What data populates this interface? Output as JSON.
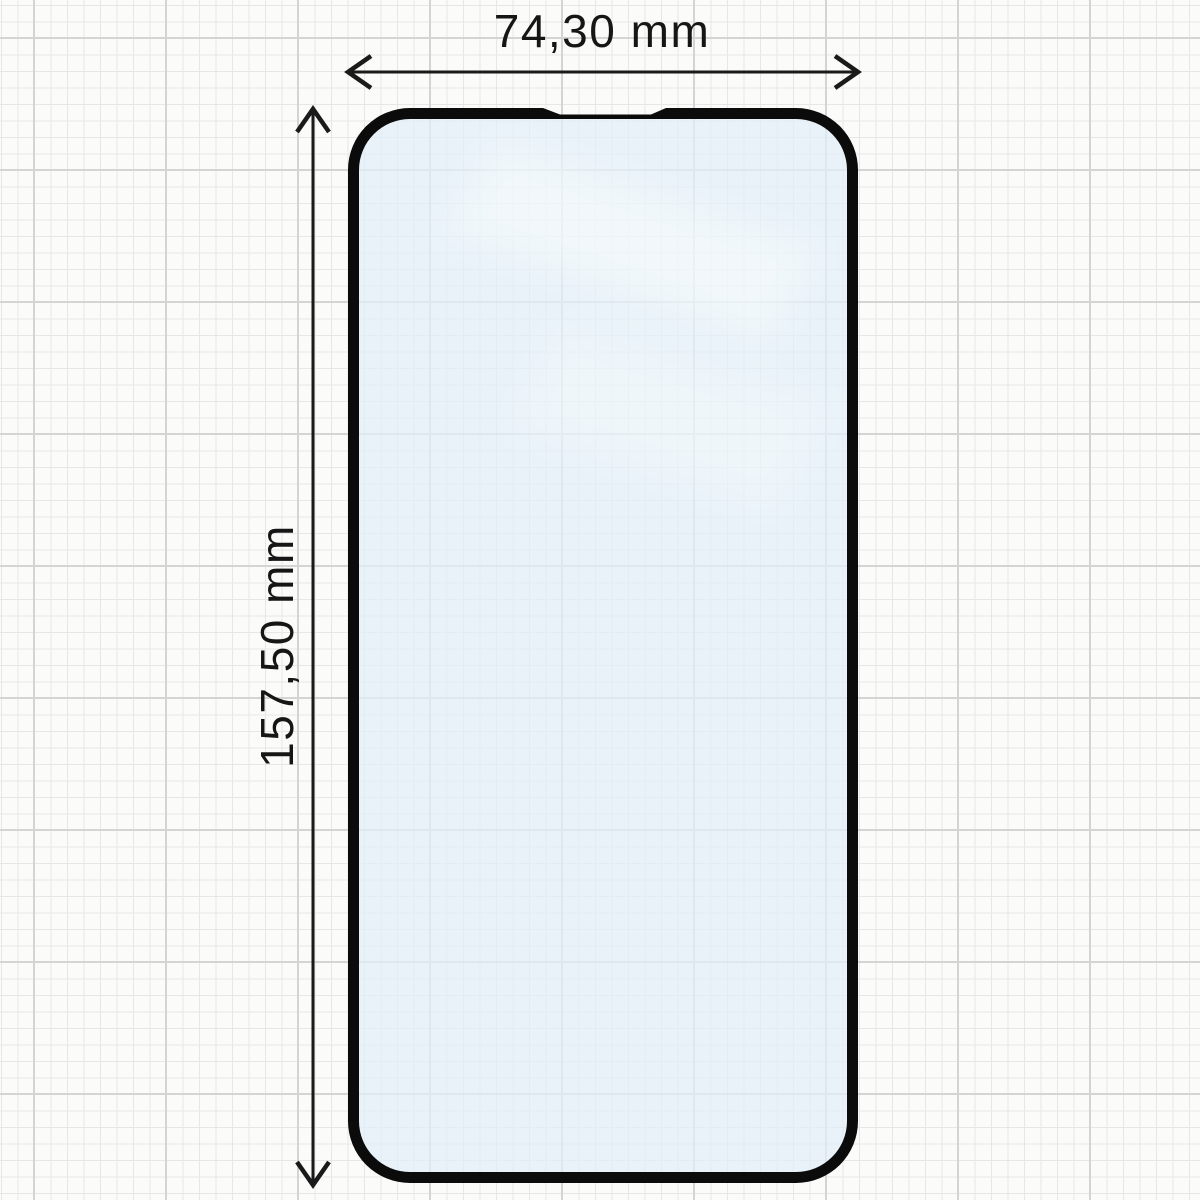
{
  "diagram": {
    "subject": "screen-protector-technical-drawing",
    "width_dimension": {
      "label": "74,30 mm"
    },
    "height_dimension": {
      "label": "157,50 mm"
    }
  },
  "colors": {
    "outline": "#0b0b0b",
    "glass_fill": "rgba(224,238,246,0.72)",
    "reflection": "#ffffff",
    "dimension_stroke": "#1a1a1a",
    "label_text": "#161616",
    "paper_background": "#fbfbfa",
    "grid_minor": "#e7e7e7",
    "grid_major": "#d4d4d4"
  }
}
